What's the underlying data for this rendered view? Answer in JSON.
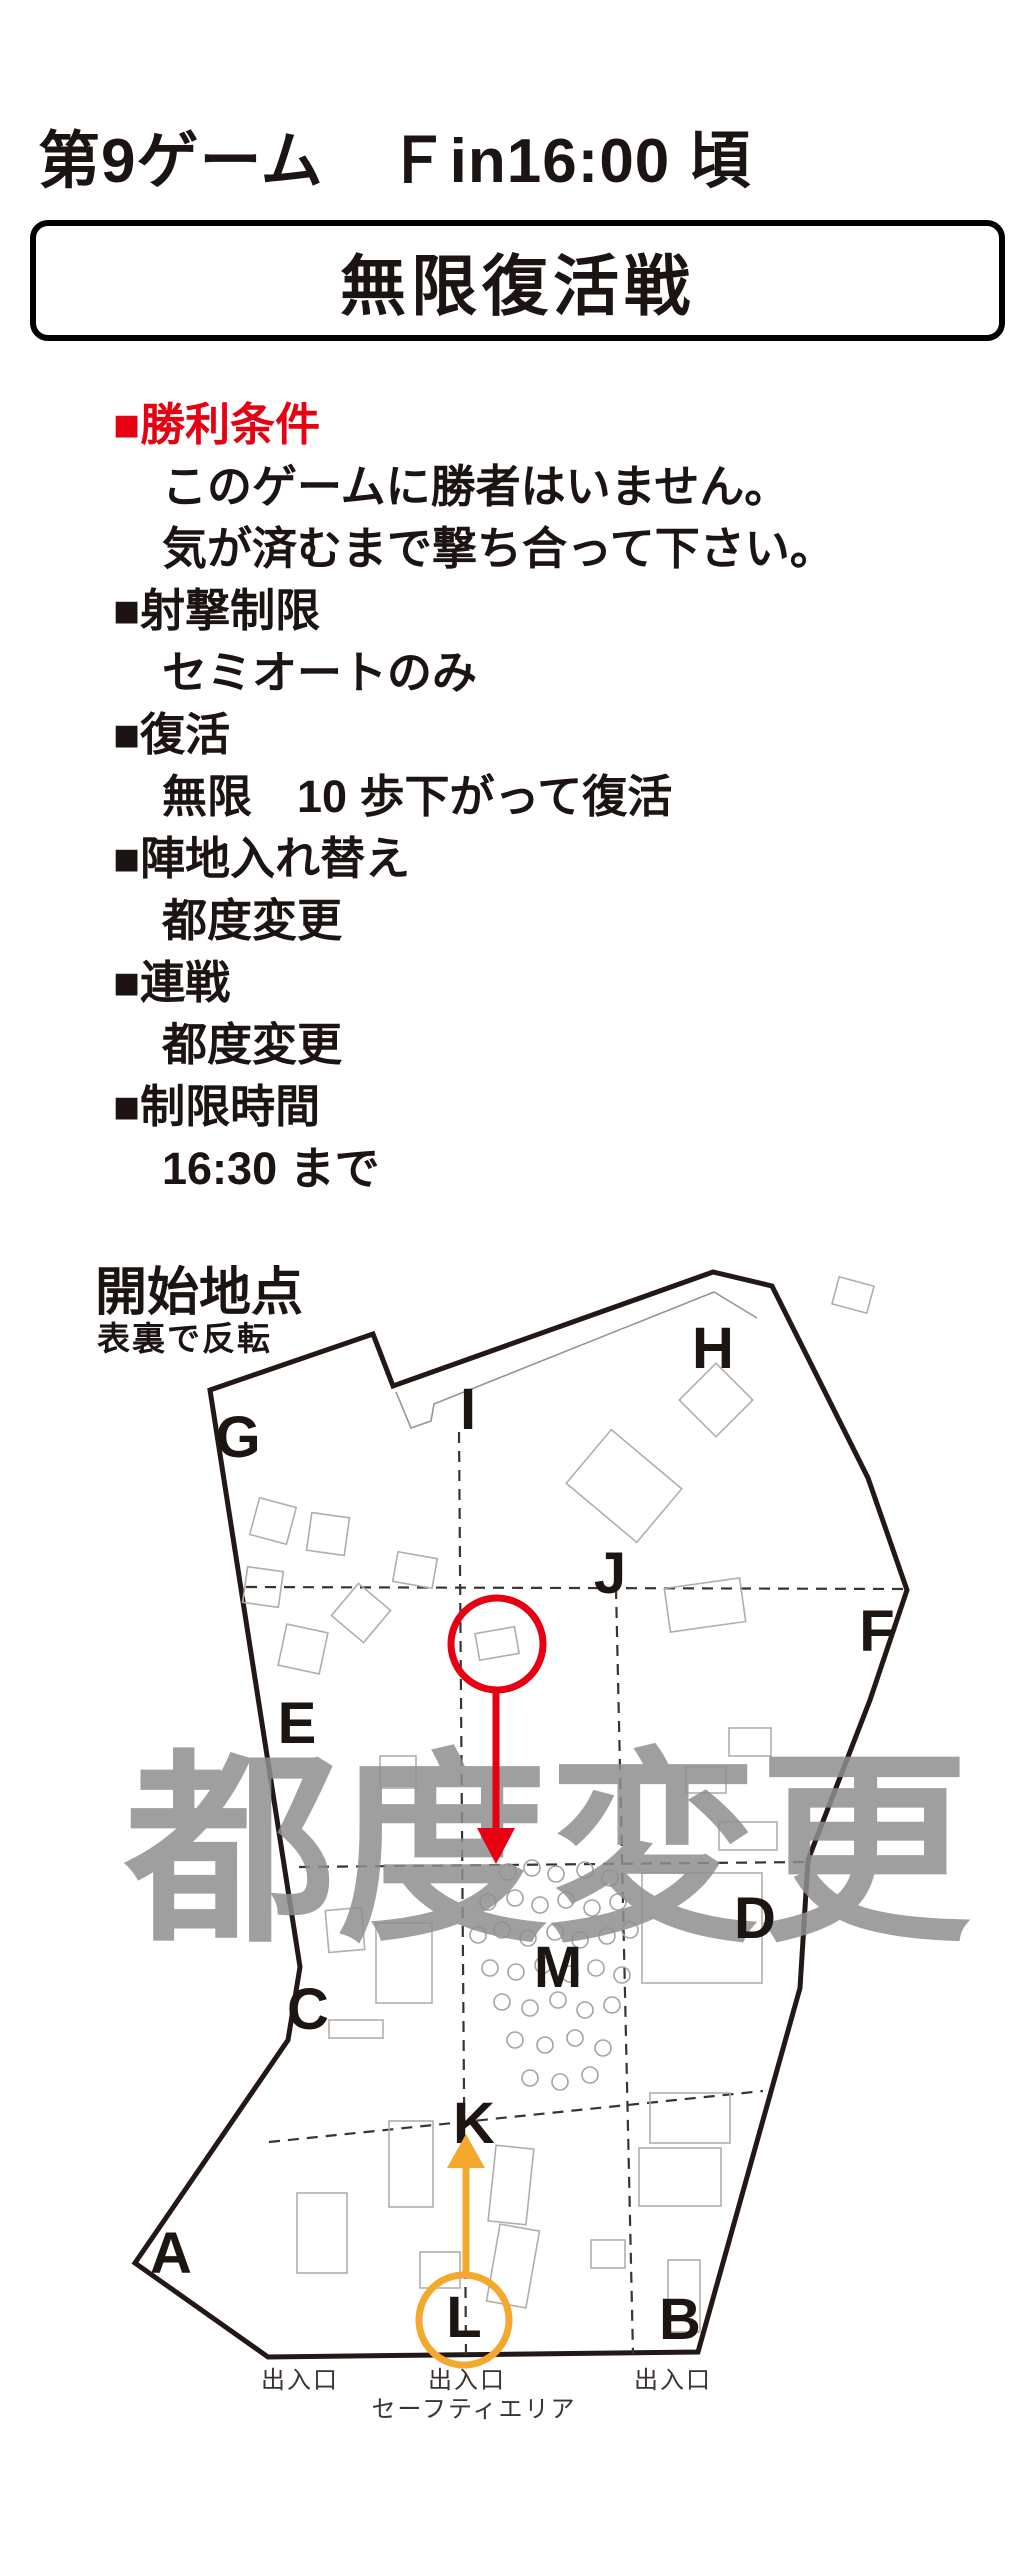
{
  "page": {
    "background": "#ffffff",
    "width": 1029,
    "height": 2560
  },
  "colors": {
    "ink": "#1c1412",
    "accent_red": "#e60012",
    "accent_orange": "#f4a82e",
    "watermark_gray": "#8e8e8e"
  },
  "header": {
    "game_title": "第9ゲーム　Ｆin16:00 頃",
    "mode_title": "無限復活戦"
  },
  "rules": {
    "items": [
      {
        "type": "heading",
        "text": "■勝利条件",
        "color": "#e60012"
      },
      {
        "type": "detail",
        "text": "このゲームに勝者はいません。"
      },
      {
        "type": "detail",
        "text": "気が済むまで撃ち合って下さい。"
      },
      {
        "type": "heading",
        "text": "■射撃制限"
      },
      {
        "type": "detail",
        "text": "セミオートのみ"
      },
      {
        "type": "heading",
        "text": "■復活"
      },
      {
        "type": "detail",
        "text": "無限　10 歩下がって復活"
      },
      {
        "type": "heading",
        "text": "■陣地入れ替え"
      },
      {
        "type": "detail",
        "text": "都度変更"
      },
      {
        "type": "heading",
        "text": "■連戦"
      },
      {
        "type": "detail",
        "text": "都度変更"
      },
      {
        "type": "heading",
        "text": "■制限時間"
      },
      {
        "type": "detail",
        "text": "16:30 まで"
      }
    ]
  },
  "map_section": {
    "title": "開始地点",
    "subtitle": "表裏で反転",
    "watermark": "都度変更",
    "letters": [
      {
        "char": "G",
        "x": 238,
        "y": 1436
      },
      {
        "char": "I",
        "x": 468,
        "y": 1408
      },
      {
        "char": "H",
        "x": 713,
        "y": 1347
      },
      {
        "char": "J",
        "x": 610,
        "y": 1572
      },
      {
        "char": "F",
        "x": 877,
        "y": 1630
      },
      {
        "char": "E",
        "x": 297,
        "y": 1722
      },
      {
        "char": "D",
        "x": 755,
        "y": 1917
      },
      {
        "char": "M",
        "x": 558,
        "y": 1966
      },
      {
        "char": "C",
        "x": 308,
        "y": 2008
      },
      {
        "char": "K",
        "x": 474,
        "y": 2122
      },
      {
        "char": "A",
        "x": 171,
        "y": 2252
      },
      {
        "char": "B",
        "x": 680,
        "y": 2318
      },
      {
        "char": "L",
        "x": 464,
        "y": 2316
      }
    ],
    "entrances": [
      {
        "label": "出入口",
        "x": 300,
        "y": 2388
      },
      {
        "label": "出入口",
        "x": 467,
        "y": 2388
      },
      {
        "label": "出入口",
        "x": 673,
        "y": 2388
      }
    ],
    "safety_label": {
      "text": "セーフティエリア",
      "x": 474,
      "y": 2417
    },
    "annotations": [
      {
        "name": "red-start-marker",
        "color": "#e60012",
        "circle": {
          "cx": 497,
          "cy": 1644,
          "r": 46
        },
        "arrow": {
          "x": 496,
          "y1": 1692,
          "y2": 1828,
          "tip": 1864
        }
      },
      {
        "name": "orange-start-marker",
        "color": "#f4a82e",
        "circle": {
          "cx": 464,
          "cy": 2320,
          "r": 45
        },
        "arrow": {
          "x": 466,
          "y1": 2272,
          "y2": 2168,
          "tip": 2134
        }
      }
    ]
  }
}
